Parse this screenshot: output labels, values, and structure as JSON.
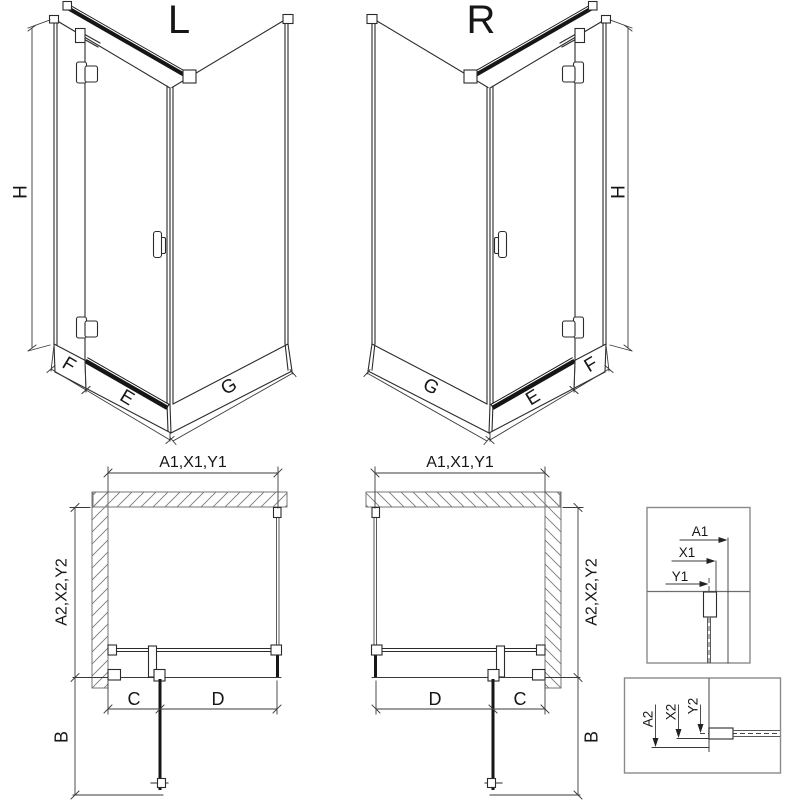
{
  "diagram": {
    "iso_left": {
      "title": "L",
      "height": "H",
      "fixed_width": "F",
      "door_width": "E",
      "side_width": "G"
    },
    "iso_right": {
      "title": "R",
      "height": "H",
      "fixed_width": "F",
      "door_width": "E",
      "side_width": "G"
    },
    "plan_left": {
      "width_dim": "A1,X1,Y1",
      "depth_dim": "A2,X2,Y2",
      "fixed_segment": "C",
      "door_segment": "D",
      "door_swing": "B"
    },
    "plan_right": {
      "width_dim": "A1,X1,Y1",
      "depth_dim": "A2,X2,Y2",
      "fixed_segment": "C",
      "door_segment": "D",
      "door_swing": "B"
    },
    "detail_top": {
      "dim_a": "A1",
      "dim_x": "X1",
      "dim_y": "Y1"
    },
    "detail_bottom": {
      "dim_a": "A2",
      "dim_x": "X2",
      "dim_y": "Y2"
    }
  },
  "colors": {
    "line": "#2b2b2b",
    "dark_frame": "#161616",
    "glass_gray": "#5a5a5a",
    "wall_gray": "#757575",
    "detail_border": "#8a8a8a",
    "background": "#ffffff"
  }
}
